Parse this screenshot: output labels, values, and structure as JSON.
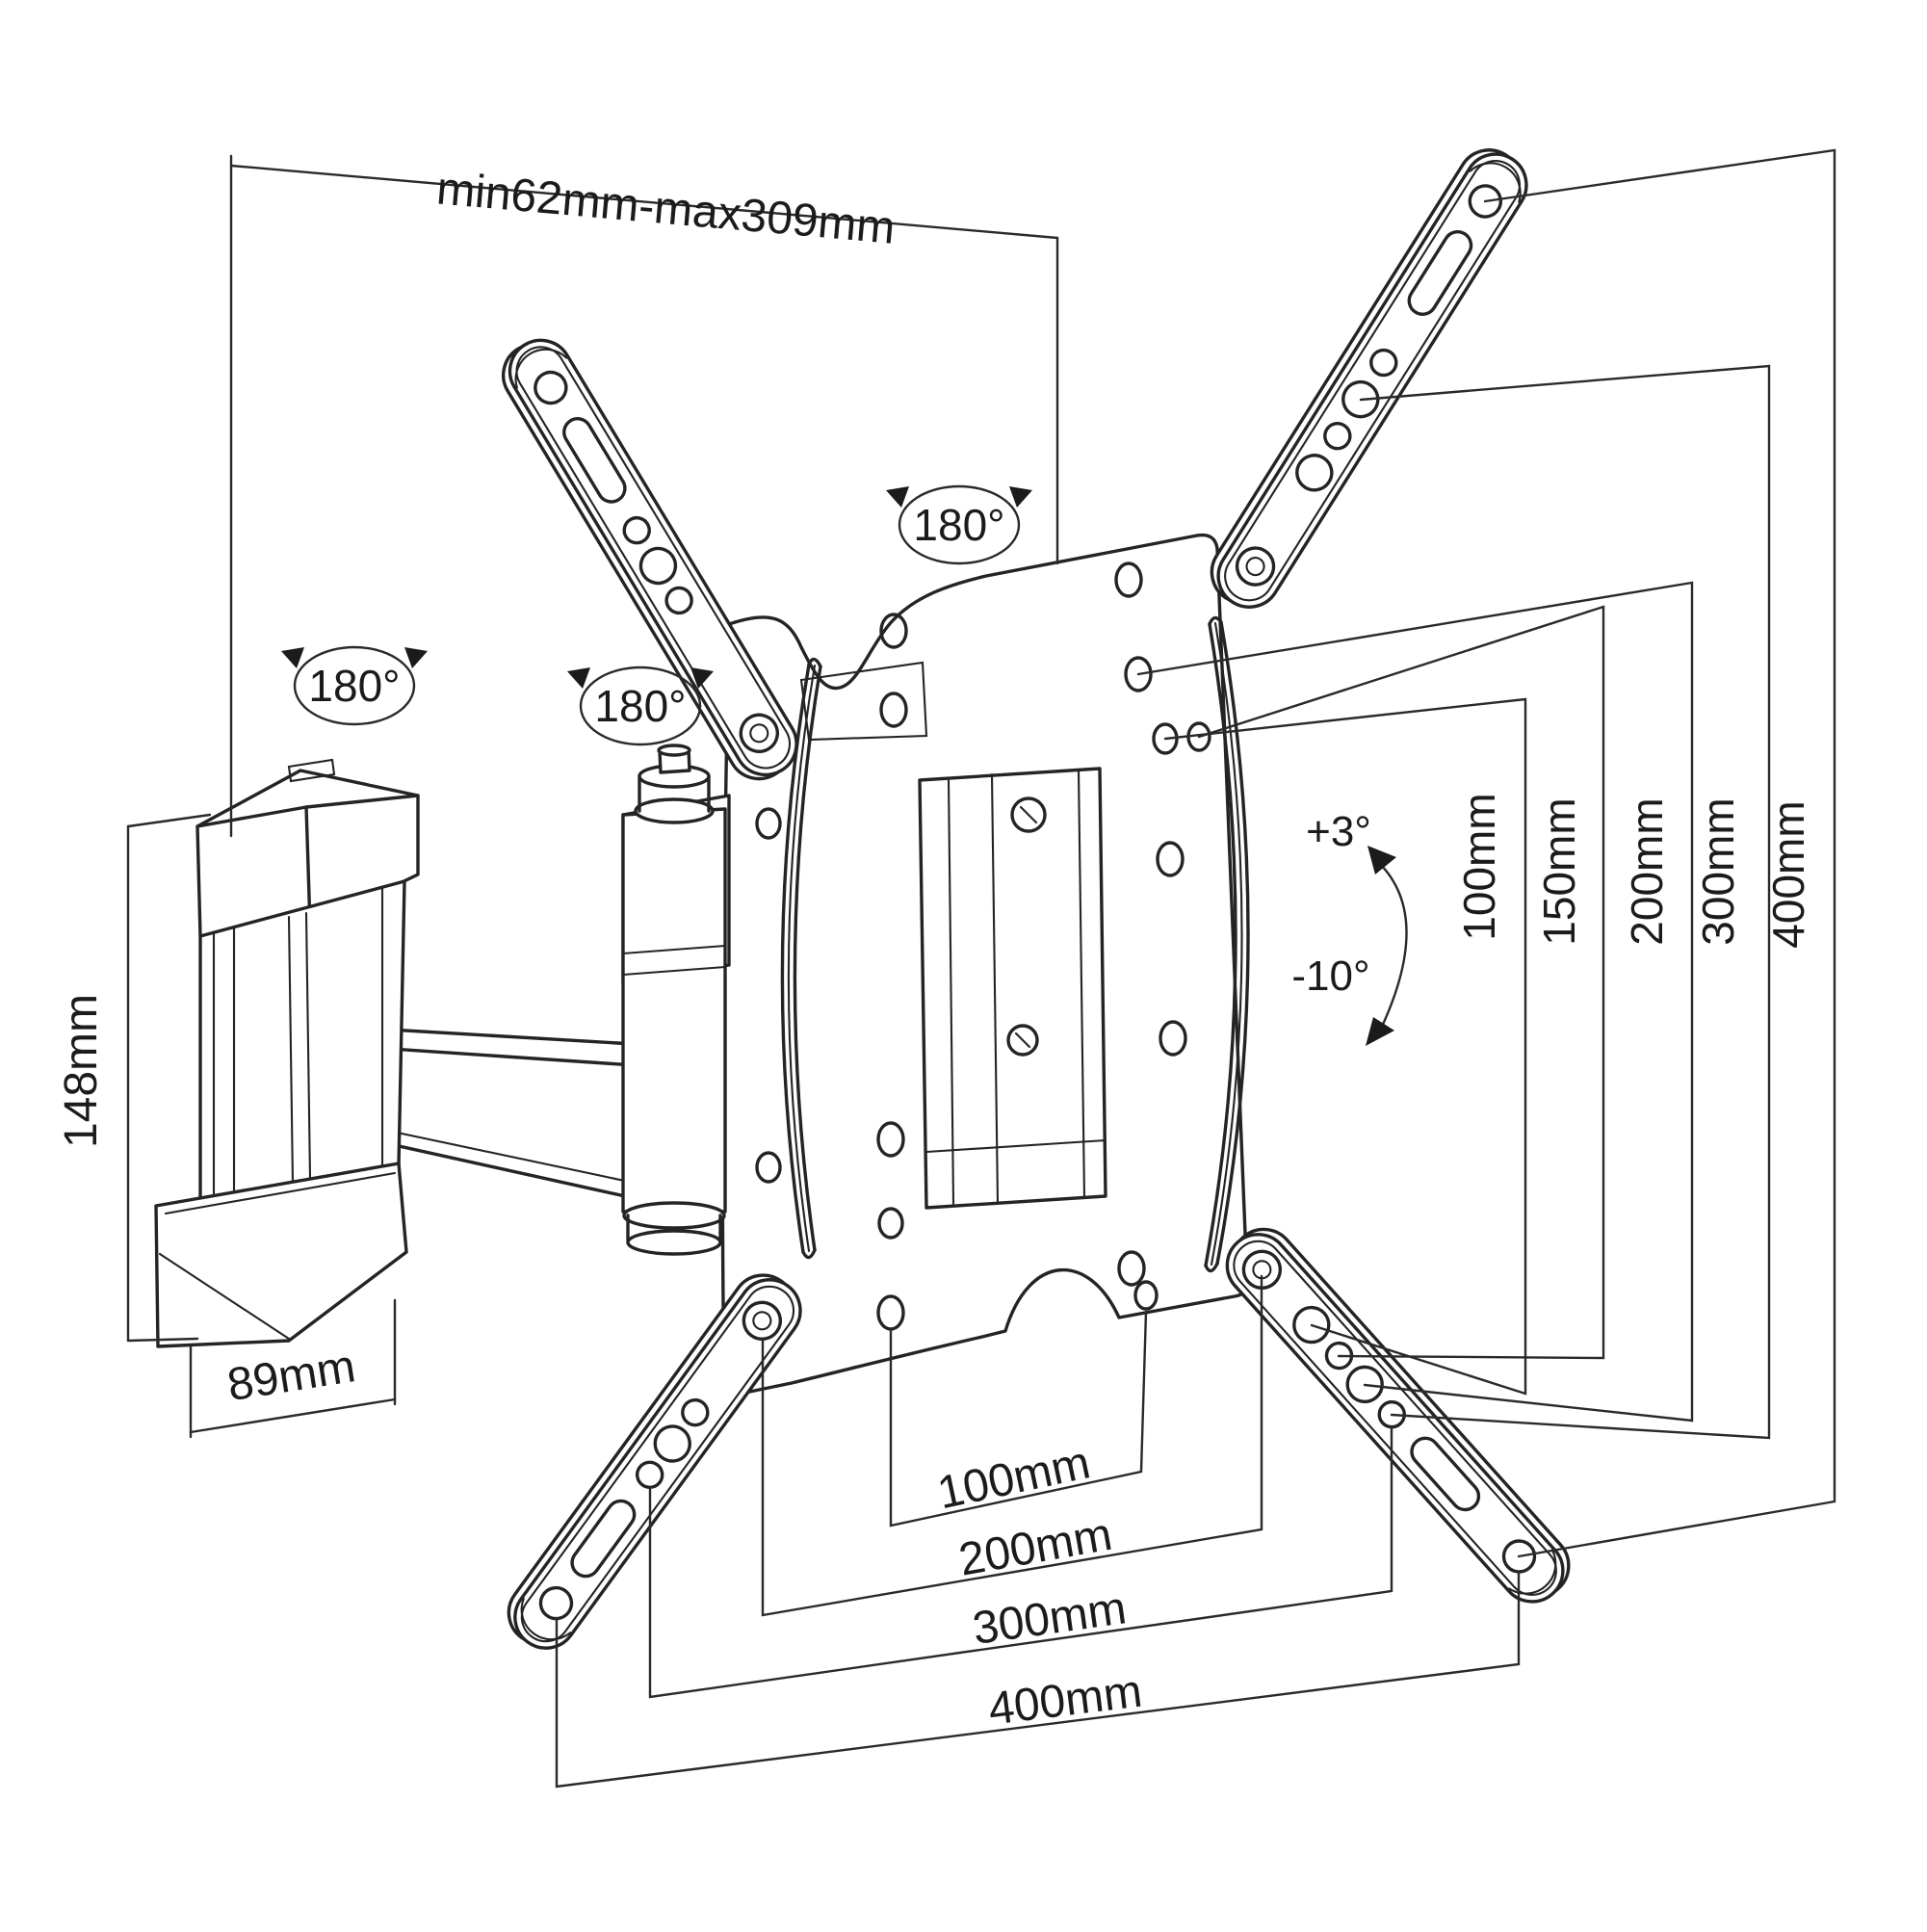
{
  "title": "Articulating TV wall mount bracket - dimensional technical drawing",
  "colors": {
    "line": "#242424",
    "background": "#ffffff"
  },
  "dims": {
    "top_range": "min62mm-max309mm",
    "height": "148mm",
    "depth": "89mm",
    "rotate_a": "180°",
    "rotate_b": "180°",
    "rotate_c": "180°",
    "tilt_up": "+3°",
    "tilt_down": "-10°",
    "vesa_v": [
      "100mm",
      "150mm",
      "200mm",
      "300mm",
      "400mm"
    ],
    "vesa_h": [
      "100mm",
      "200mm",
      "300mm",
      "400mm"
    ]
  }
}
